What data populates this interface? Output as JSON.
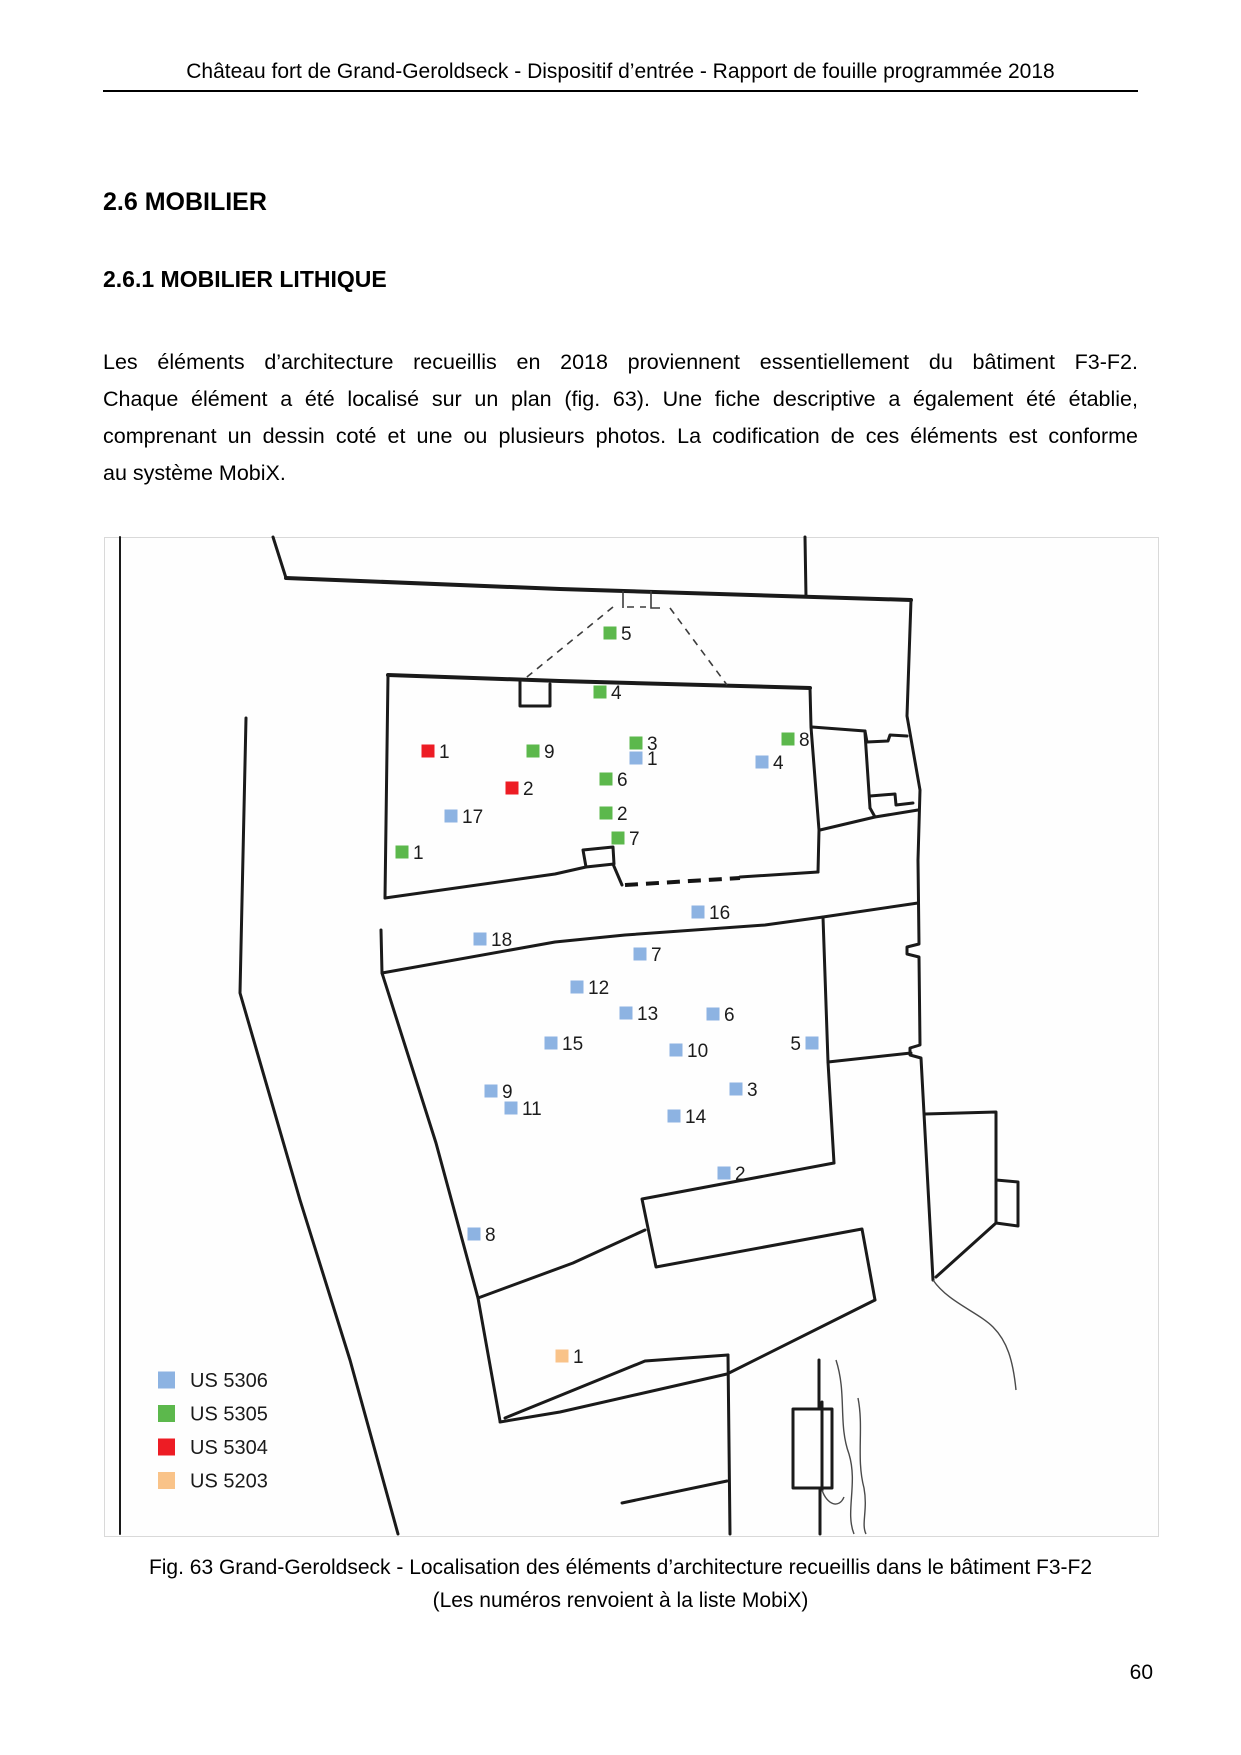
{
  "header": {
    "title": "Château fort de Grand-Geroldseck - Dispositif d’entrée - Rapport de fouille programmée 2018"
  },
  "sections": {
    "h1": "2.6 MOBILIER",
    "h2": "2.6.1 MOBILIER LITHIQUE"
  },
  "paragraph": {
    "lines": [
      "Les éléments d’architecture recueillis en 2018 proviennent essentiellement du bâtiment F3-F2.",
      "Chaque élément a été localisé sur un plan (fig. 63). Une fiche descriptive a également été établie,",
      "comprenant un dessin coté et une ou plusieurs photos. La codification de ces éléments est conforme",
      "au système MobiX."
    ]
  },
  "figure": {
    "caption_line1": "Fig. 63 Grand-Geroldseck - Localisation des éléments d’architecture recueillis dans le bâtiment F3-F2",
    "caption_line2": "(Les numéros renvoient à la liste MobiX)",
    "legend": [
      {
        "label": "US 5306",
        "color": "#8db3e2"
      },
      {
        "label": "US 5305",
        "color": "#5cb84c"
      },
      {
        "label": "US 5304",
        "color": "#ed1c24"
      },
      {
        "label": "US 5203",
        "color": "#f9c389"
      }
    ],
    "legend_layout": {
      "x_square": 158,
      "x_text": 190,
      "y_start": 1380,
      "y_step": 33.5,
      "square_size": 17
    },
    "markers": [
      {
        "us": "US 5305",
        "n": "5",
        "x": 610,
        "y": 633
      },
      {
        "us": "US 5305",
        "n": "4",
        "x": 600,
        "y": 692
      },
      {
        "us": "US 5305",
        "n": "3",
        "x": 636,
        "y": 743
      },
      {
        "us": "US 5305",
        "n": "9",
        "x": 533,
        "y": 751
      },
      {
        "us": "US 5305",
        "n": "8",
        "x": 788,
        "y": 739
      },
      {
        "us": "US 5305",
        "n": "6",
        "x": 606,
        "y": 779
      },
      {
        "us": "US 5305",
        "n": "2",
        "x": 606,
        "y": 813
      },
      {
        "us": "US 5305",
        "n": "7",
        "x": 618,
        "y": 838
      },
      {
        "us": "US 5305",
        "n": "1",
        "x": 402,
        "y": 852
      },
      {
        "us": "US 5304",
        "n": "1",
        "x": 428,
        "y": 751
      },
      {
        "us": "US 5304",
        "n": "2",
        "x": 512,
        "y": 788
      },
      {
        "us": "US 5306",
        "n": "1",
        "x": 636,
        "y": 758
      },
      {
        "us": "US 5306",
        "n": "4",
        "x": 762,
        "y": 762
      },
      {
        "us": "US 5306",
        "n": "17",
        "x": 451,
        "y": 816
      },
      {
        "us": "US 5306",
        "n": "16",
        "x": 698,
        "y": 912
      },
      {
        "us": "US 5306",
        "n": "18",
        "x": 480,
        "y": 939
      },
      {
        "us": "US 5306",
        "n": "7",
        "x": 640,
        "y": 954
      },
      {
        "us": "US 5306",
        "n": "12",
        "x": 577,
        "y": 987
      },
      {
        "us": "US 5306",
        "n": "13",
        "x": 626,
        "y": 1013
      },
      {
        "us": "US 5306",
        "n": "6",
        "x": 713,
        "y": 1014
      },
      {
        "us": "US 5306",
        "n": "15",
        "x": 551,
        "y": 1043
      },
      {
        "us": "US 5306",
        "n": "10",
        "x": 676,
        "y": 1050
      },
      {
        "us": "US 5306",
        "n": "5",
        "x": 812,
        "y": 1043,
        "side": "left"
      },
      {
        "us": "US 5306",
        "n": "9",
        "x": 491,
        "y": 1091
      },
      {
        "us": "US 5306",
        "n": "3",
        "x": 736,
        "y": 1089
      },
      {
        "us": "US 5306",
        "n": "11",
        "x": 511,
        "y": 1108
      },
      {
        "us": "US 5306",
        "n": "14",
        "x": 674,
        "y": 1116
      },
      {
        "us": "US 5306",
        "n": "2",
        "x": 724,
        "y": 1173
      },
      {
        "us": "US 5306",
        "n": "8",
        "x": 474,
        "y": 1234
      },
      {
        "us": "US 5203",
        "n": "1",
        "x": 562,
        "y": 1356
      }
    ]
  },
  "page_number": "60"
}
